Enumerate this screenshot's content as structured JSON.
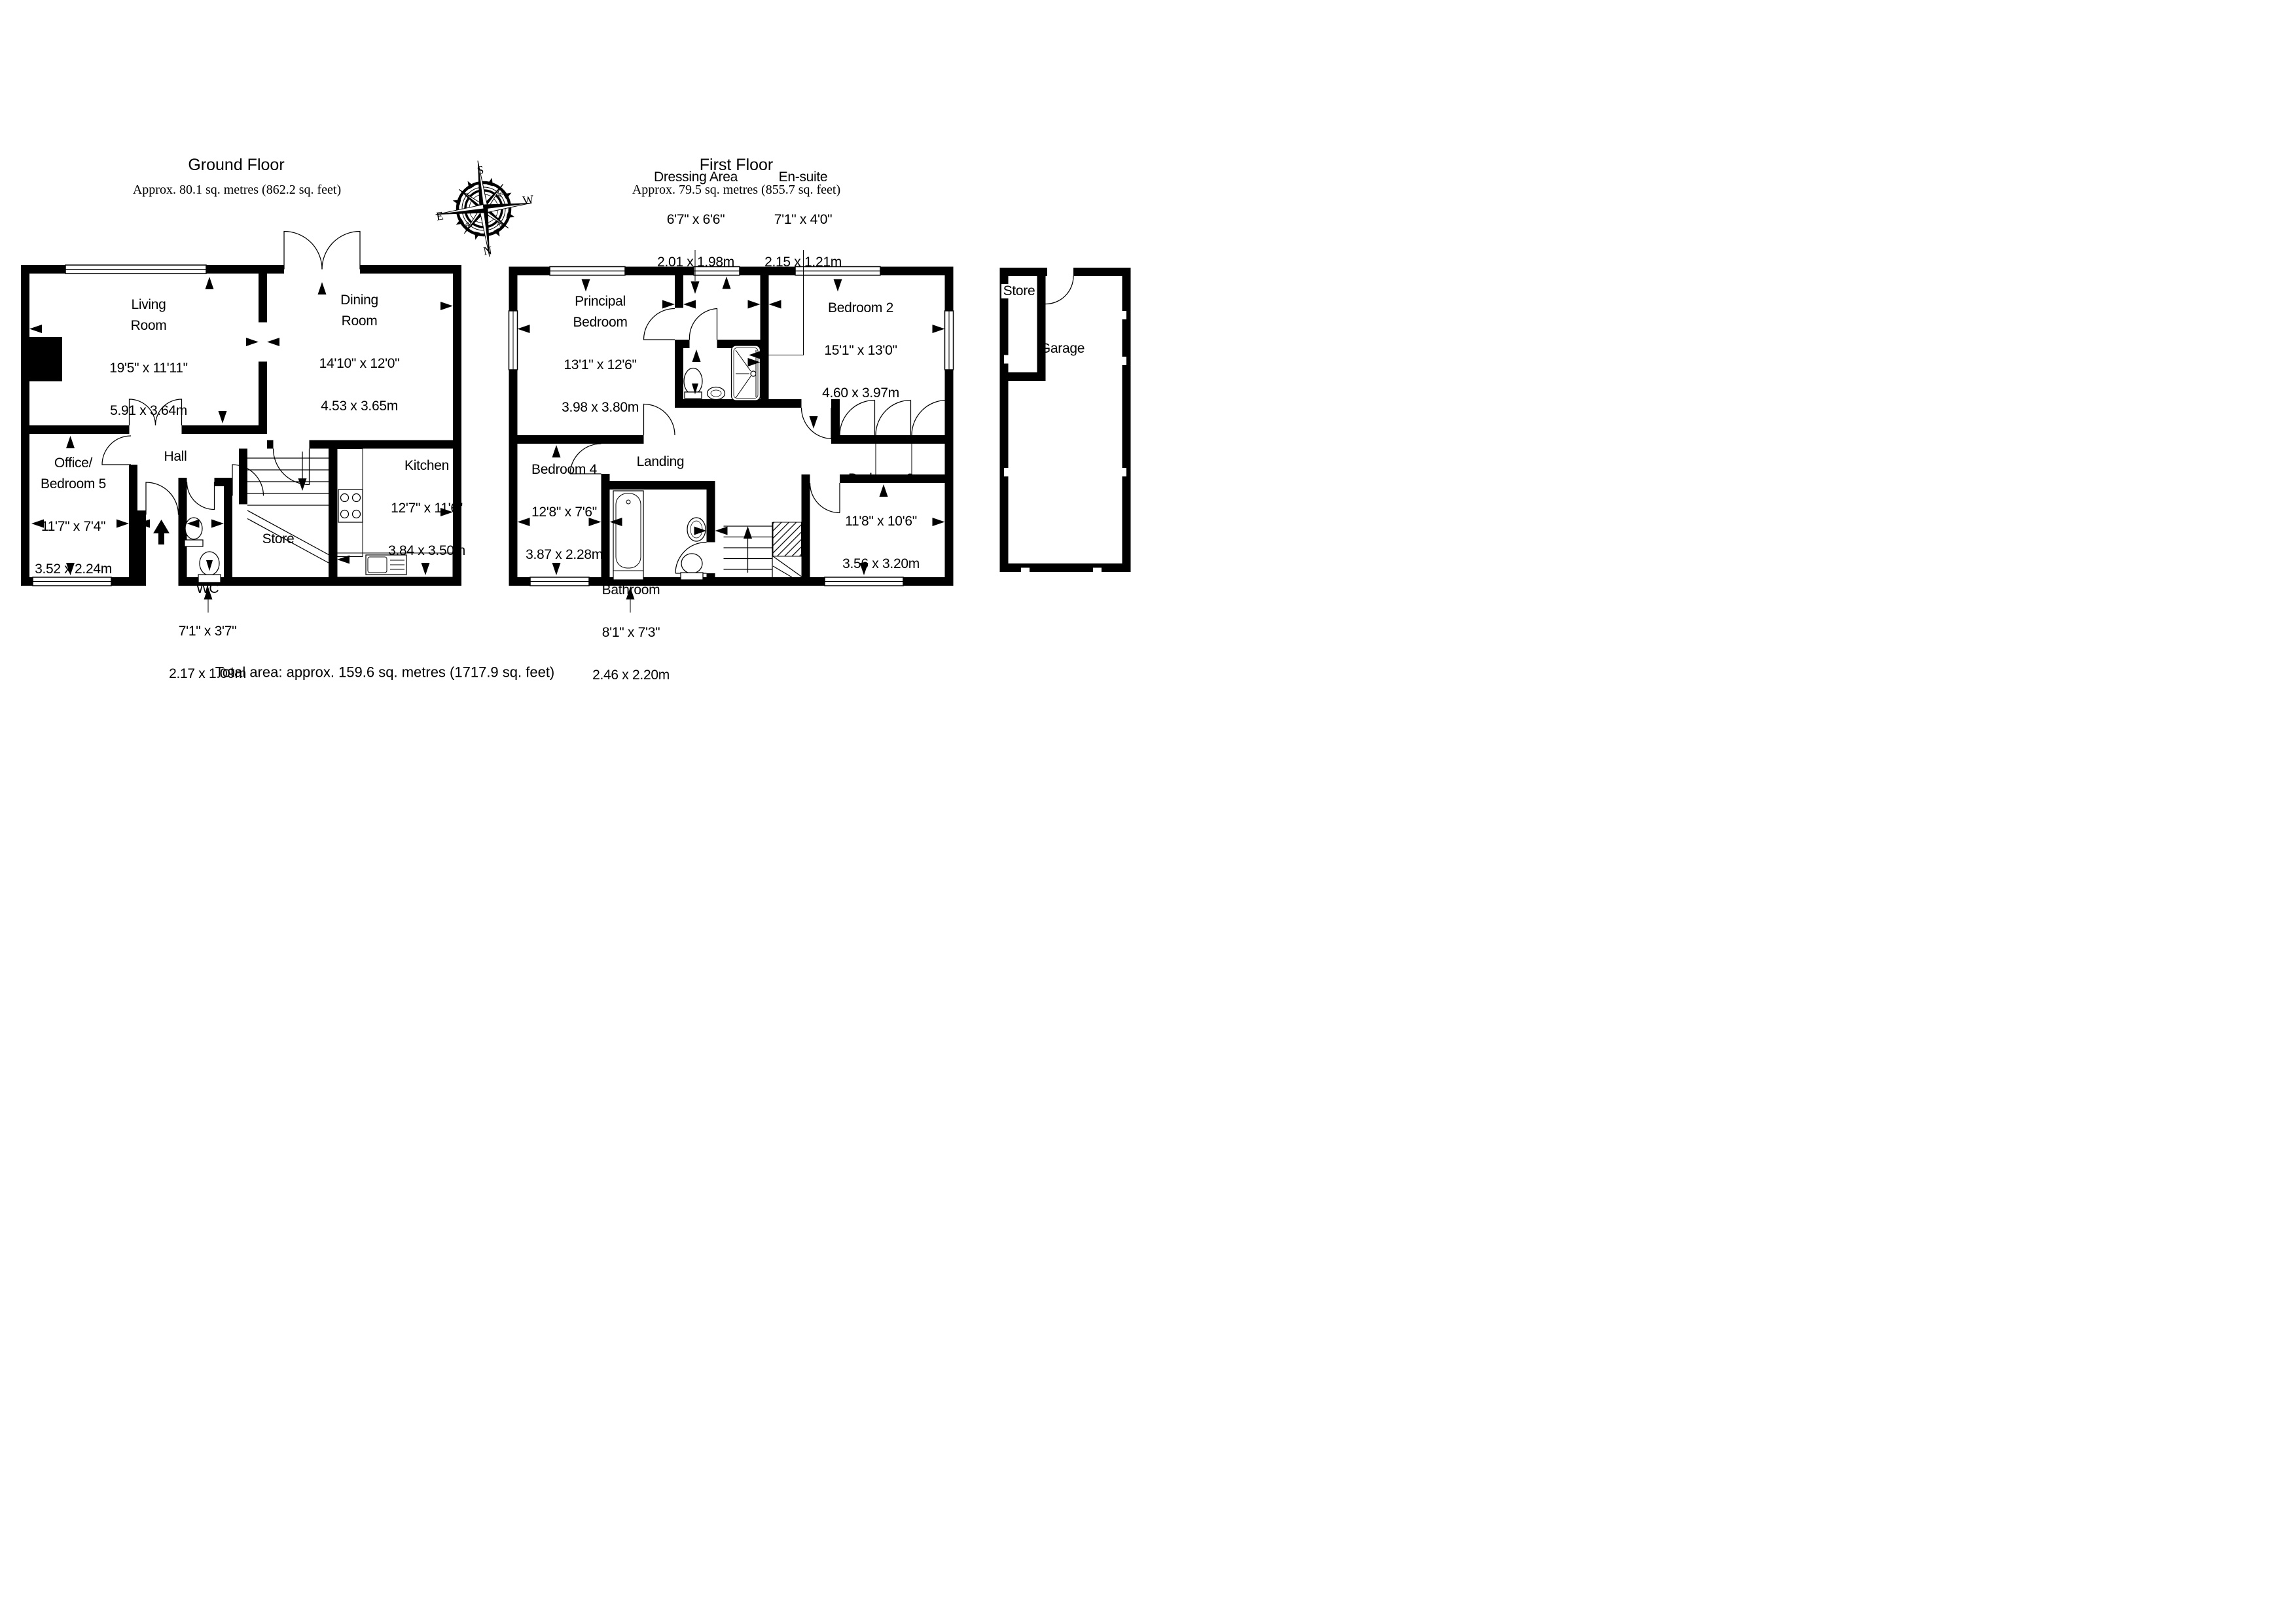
{
  "page": {
    "background": "#ffffff",
    "ink": "#000000"
  },
  "ground_floor": {
    "title": "Ground Floor",
    "subtitle": "Approx. 80.1 sq. metres (862.2 sq. feet)",
    "rooms": {
      "living": {
        "name": "Living\nRoom",
        "imperial": "19'5\" x 11'11\"",
        "metric": "5.91 x 3.64m"
      },
      "dining": {
        "name": "Dining\nRoom",
        "imperial": "14'10\" x 12'0\"",
        "metric": "4.53 x 3.65m"
      },
      "hall": {
        "name": "Hall"
      },
      "office": {
        "name": "Office/\nBedroom 5",
        "imperial": "11'7\" x 7'4\"",
        "metric": "3.52 x 2.24m"
      },
      "wc": {
        "name": "WC",
        "imperial": "7'1\" x 3'7\"",
        "metric": "2.17 x 1.09m"
      },
      "store": {
        "name": "Store"
      },
      "kitchen": {
        "name": "Kitchen",
        "imperial": "12'7\" x 11'6\"",
        "metric": "3.84 x 3.50m"
      }
    }
  },
  "first_floor": {
    "title": "First Floor",
    "subtitle": "Approx. 79.5 sq. metres (855.7 sq. feet)",
    "rooms": {
      "dressing": {
        "name": "Dressing Area",
        "imperial": "6'7\" x 6'6\"",
        "metric": "2.01 x 1.98m"
      },
      "ensuite": {
        "name": "En-suite",
        "imperial": "7'1\" x 4'0\"",
        "metric": "2.15 x 1.21m"
      },
      "principal": {
        "name": "Principal\nBedroom",
        "imperial": "13'1\" x 12'6\"",
        "metric": "3.98 x 3.80m"
      },
      "bedroom2": {
        "name": "Bedroom 2",
        "imperial": "15'1\" x 13'0\"",
        "metric": "4.60 x 3.97m"
      },
      "bedroom4": {
        "name": "Bedroom 4",
        "imperial": "12'8\" x 7'6\"",
        "metric": "3.87 x 2.28m"
      },
      "landing": {
        "name": "Landing"
      },
      "bedroom3": {
        "name": "Bedroom 3",
        "imperial": "11'8\" x 10'6\"",
        "metric": "3.56 x 3.20m"
      },
      "bathroom": {
        "name": "Bathroom",
        "imperial": "8'1\" x 7'3\"",
        "metric": "2.46 x 2.20m"
      }
    }
  },
  "garage": {
    "store": "Store",
    "label": "Garage"
  },
  "total_area": "Total area: approx. 159.6 sq. metres (1717.9 sq. feet)",
  "compass": {
    "n": "N",
    "s": "S",
    "e": "E",
    "w": "W",
    "ne": "ne",
    "nw": "nw",
    "se": "se",
    "sw": "sw"
  }
}
